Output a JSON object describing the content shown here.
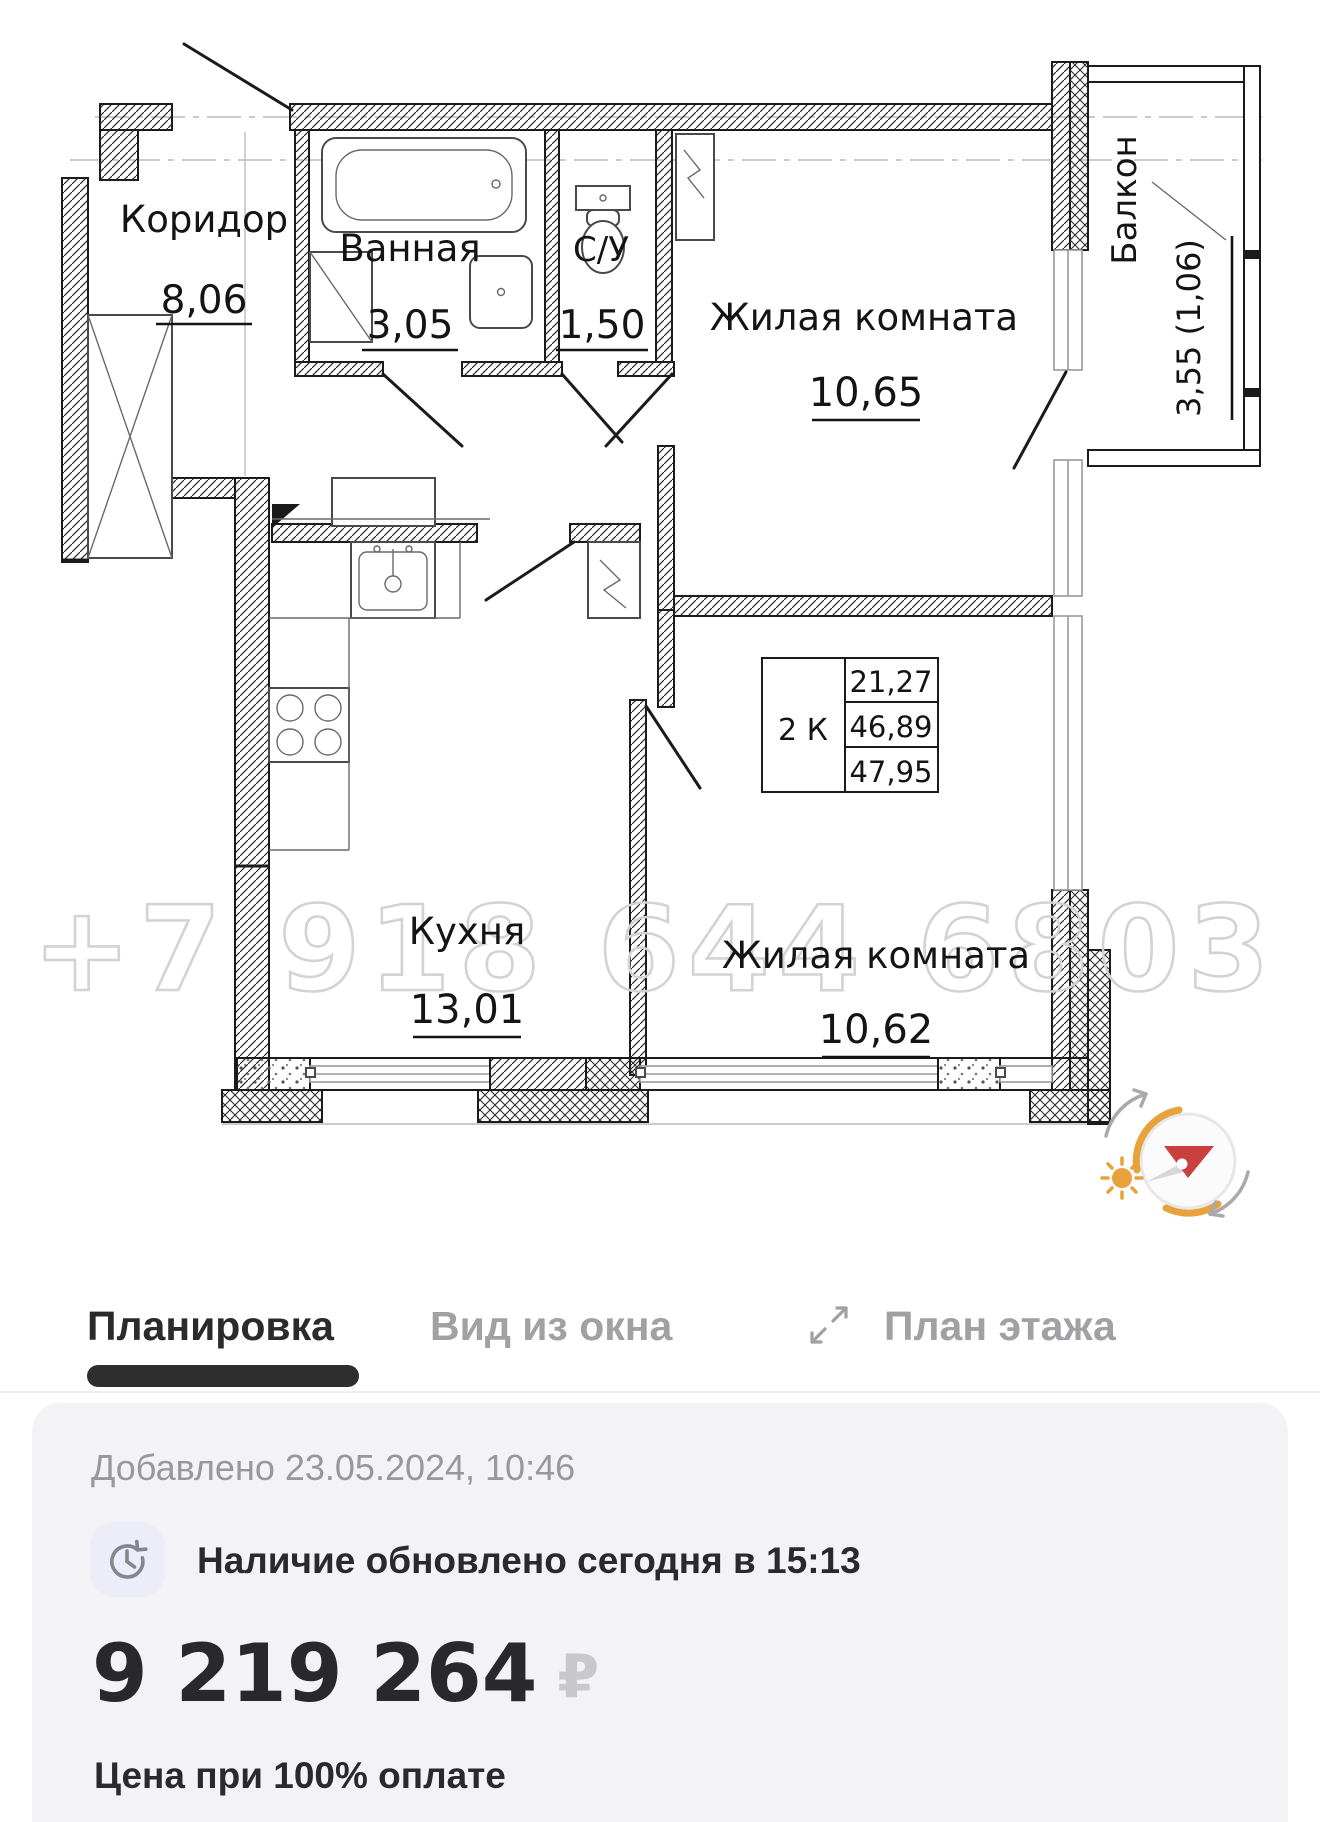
{
  "plan": {
    "watermark": "+7 918 644 6803",
    "rooms": {
      "corridor": {
        "name": "Коридор",
        "area": "8,06"
      },
      "bathroom": {
        "name": "Ванная",
        "area": "3,05"
      },
      "wc": {
        "name": "С/У",
        "area": "1,50"
      },
      "living_top": {
        "name": "Жилая комната",
        "area": "10,65"
      },
      "kitchen": {
        "name": "Кухня",
        "area": "13,01"
      },
      "living_bottom": {
        "name": "Жилая комната",
        "area": "10,62"
      },
      "balcony": {
        "name": "Балкон",
        "area": "3,55 (1,06)"
      }
    },
    "summary": {
      "type": "2 К",
      "living_area": "21,27",
      "area_without_balcony": "46,89",
      "total_area": "47,95"
    }
  },
  "tabs": {
    "layout": "Планировка",
    "window_view": "Вид из окна",
    "floor_plan": "План этажа"
  },
  "card": {
    "added": "Добавлено 23.05.2024, 10:46",
    "availability": "Наличие обновлено сегодня в 15:13",
    "price": "9 219 264",
    "currency": "₽",
    "note": "Цена при 100% оплате"
  },
  "colors": {
    "compass_orange": "#e8a23c",
    "compass_red": "#c9403e",
    "active_tab": "#2b2b2e",
    "inactive_tab": "#a1a1a5",
    "card_bg": "#f3f3f5"
  }
}
